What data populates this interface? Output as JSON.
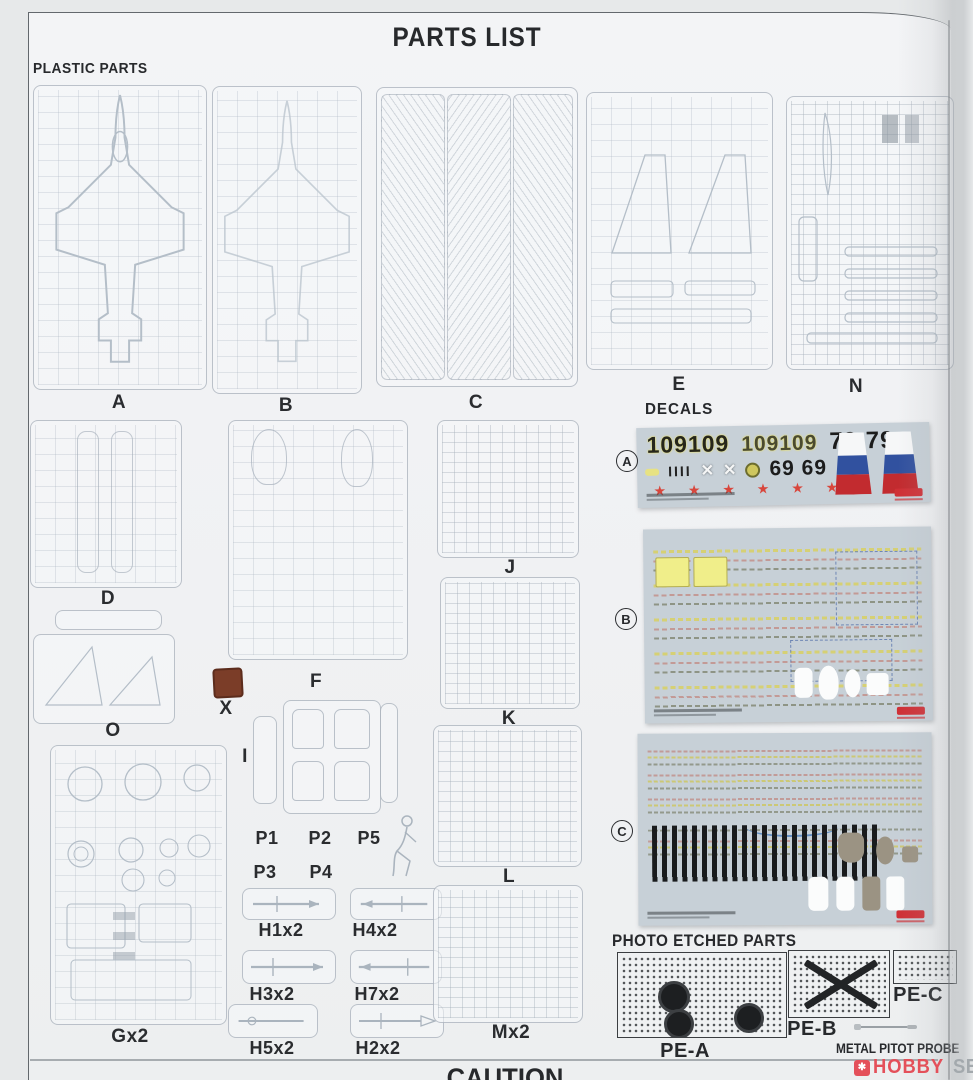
{
  "page": {
    "title": "PARTS LIST",
    "plastic_parts_heading": "PLASTIC PARTS",
    "decals_heading": "DECALS",
    "photo_etched_heading": "PHOTO ETCHED PARTS",
    "metal_pitot_label": "METAL PITOT PROBE",
    "caution_heading": "CAUTION"
  },
  "sprues": {
    "A": "A",
    "B": "B",
    "C": "C",
    "D": "D",
    "E": "E",
    "F": "F",
    "G": "Gx2",
    "I": "I",
    "J": "J",
    "K": "K",
    "L": "L",
    "M": "Mx2",
    "N": "N",
    "O": "O",
    "X": "X",
    "P1": "P1",
    "P2": "P2",
    "P3": "P3",
    "P4": "P4",
    "P5": "P5",
    "H1": "H1x2",
    "H2": "H2x2",
    "H3": "H3x2",
    "H4": "H4x2",
    "H5": "H5x2",
    "H7": "H7x2"
  },
  "decals": {
    "sheet_a": {
      "label": "A",
      "row1_a": "109109",
      "row1_b": "109109",
      "row1_c": "79 79",
      "row2_ticks": "IIII",
      "row2_x1": "✕",
      "row2_x2": "✕",
      "row2_num": "69 69",
      "stars": "★ ★ ★ ★ ★ ★"
    },
    "sheet_b": {
      "label": "B"
    },
    "sheet_c": {
      "label": "C"
    }
  },
  "photo_etched": {
    "pe_a": "PE-A",
    "pe_b": "PE-B",
    "pe_c": "PE-C"
  },
  "watermark": {
    "hobby": "HOBBY",
    "search": "SEARCH"
  },
  "colors": {
    "paper": "#eff1f2",
    "page_line": "#5f6468",
    "sprue_line": "#c3cbd3",
    "label_ink": "#27292c",
    "decal_bg": "#c7d0d7",
    "star_red": "#d8463c",
    "flag_blue": "#31519f",
    "flag_red": "#c22b2f",
    "stencil_yellow": "#eae37a",
    "swatch_brown": "#7b3d28",
    "pe_ink": "#2b2e30",
    "watermark_red": "#e4505a",
    "watermark_gray": "#a3a9ad"
  }
}
